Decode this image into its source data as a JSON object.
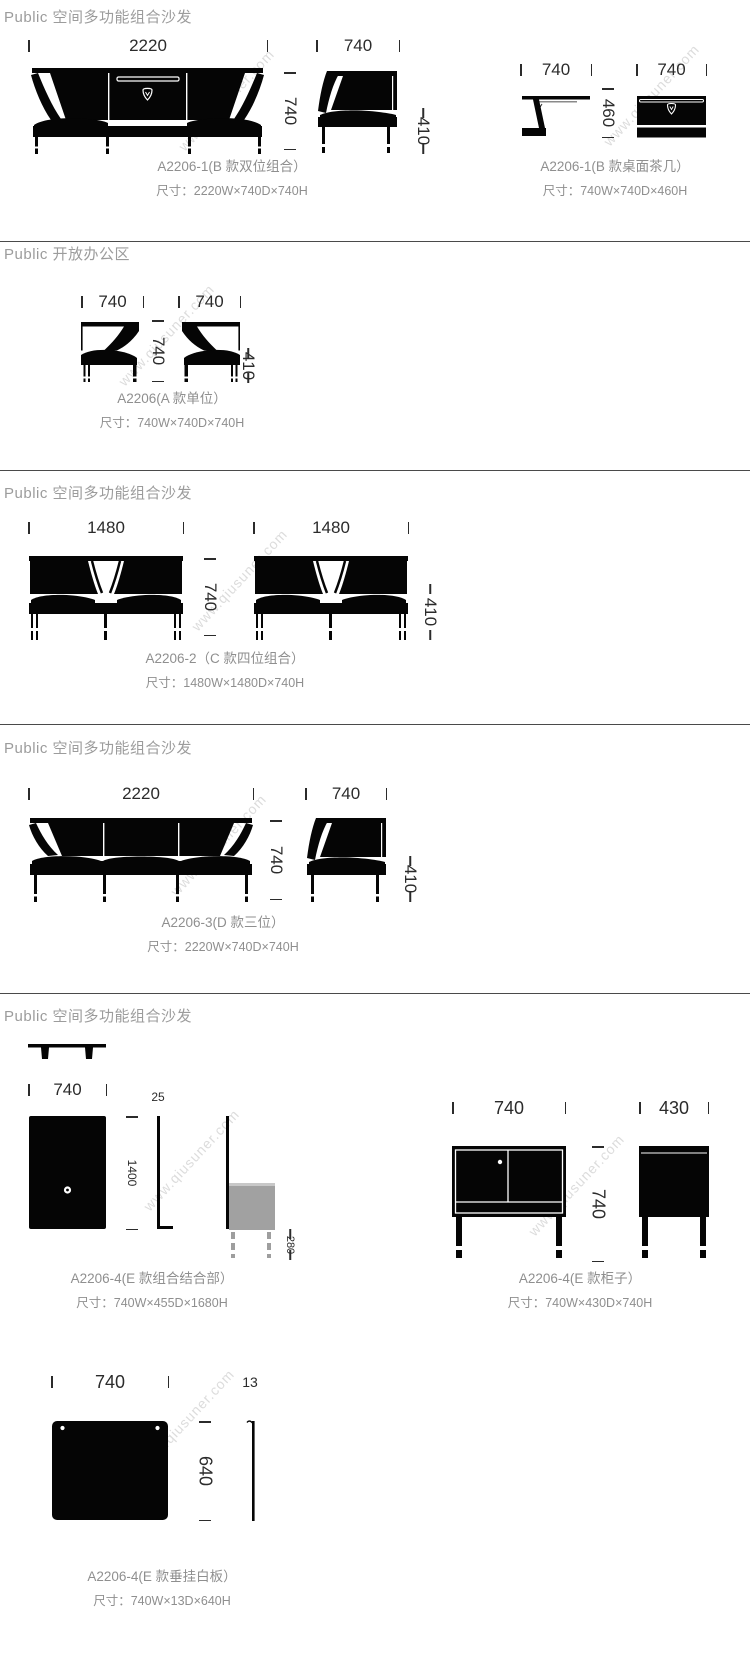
{
  "watermark": {
    "text": "www.qiusuner.com"
  },
  "sections": [
    {
      "header": "Public 空间多功能组合沙发",
      "left": {
        "title": "A2206-1(B 款双位组合）",
        "size": "尺寸：2220W×740D×740H",
        "w": "2220",
        "d": "740",
        "side_w": "740",
        "seat_h": "410"
      },
      "right": {
        "title": "A2206-1(B 款桌面茶几）",
        "size": "尺寸：740W×740D×460H",
        "side_w": "740",
        "h": "460",
        "front_w": "740"
      }
    },
    {
      "header": "Public 开放办公区",
      "item": {
        "title": "A2206(A 款单位）",
        "size": "尺寸：740W×740D×740H",
        "w1": "740",
        "w2": "740",
        "d": "740",
        "seat_h": "410"
      }
    },
    {
      "header": "Public 空间多功能组合沙发",
      "item": {
        "title": "A2206-2（C 款四位组合）",
        "size": "尺寸：1480W×1480D×740H",
        "w1": "1480",
        "w2": "1480",
        "d": "740",
        "seat_h": "410"
      }
    },
    {
      "header": "Public 空间多功能组合沙发",
      "item": {
        "title": "A2206-3(D 款三位）",
        "size": "尺寸：2220W×740D×740H",
        "w": "2220",
        "d": "740",
        "side_w": "740",
        "seat_h": "410"
      }
    },
    {
      "header": "Public 空间多功能组合沙发",
      "combo": {
        "title": "A2206-4(E 款组合结合部）",
        "size": "尺寸：740W×455D×1680H",
        "w": "740",
        "thickness": "25",
        "h": "1400",
        "leg_h": "280"
      },
      "cabinet": {
        "title": "A2206-4(E 款柜子）",
        "size": "尺寸：740W×430D×740H",
        "w": "740",
        "h": "740",
        "d": "430"
      },
      "board": {
        "title": "A2206-4(E 款垂挂白板）",
        "size": "尺寸：740W×13D×640H",
        "w": "740",
        "thickness": "13",
        "h": "640"
      }
    }
  ]
}
